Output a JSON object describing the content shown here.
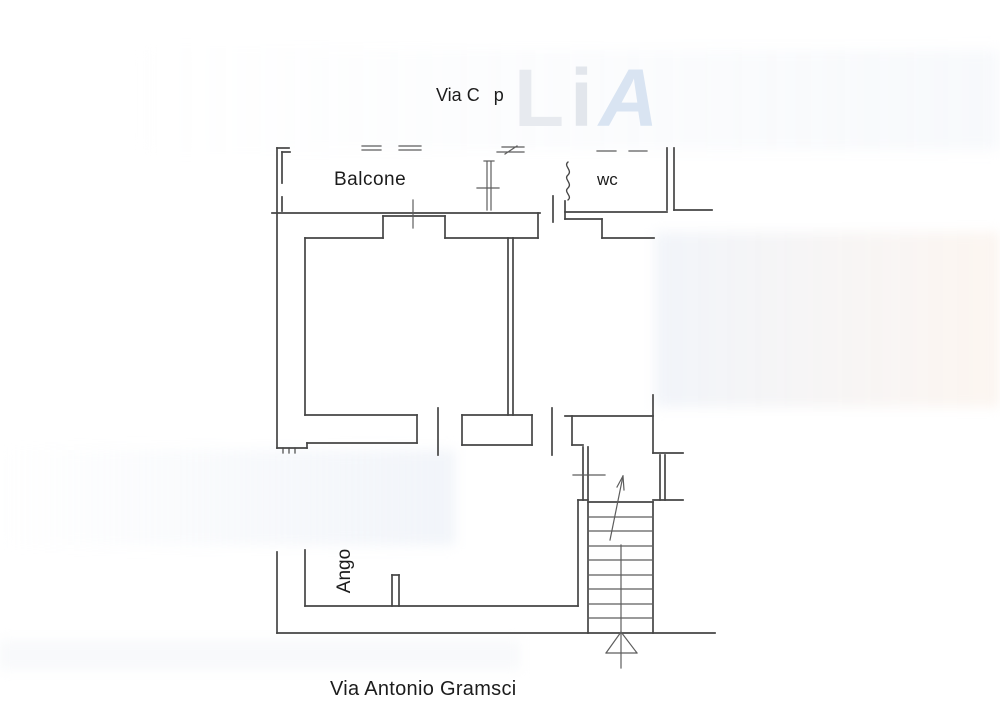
{
  "colors": {
    "line": "#454545",
    "line_thin": "#5d5d5d",
    "text": "#1c1c1c",
    "watermark_gray": "#e7eaef",
    "watermark_gray2": "#e2e6ec",
    "watermark_blue": "#d9e4f2",
    "background": "#ffffff"
  },
  "labels": {
    "street_top_part1": "Via C",
    "street_top_part2": "p",
    "balcony": "Balcone",
    "wc": "wc",
    "kitchen_corner": "Ango",
    "street_bottom": "Via Antonio Gramsci"
  },
  "watermark": {
    "part1": "L",
    "part2": "i",
    "part3": "A"
  }
}
